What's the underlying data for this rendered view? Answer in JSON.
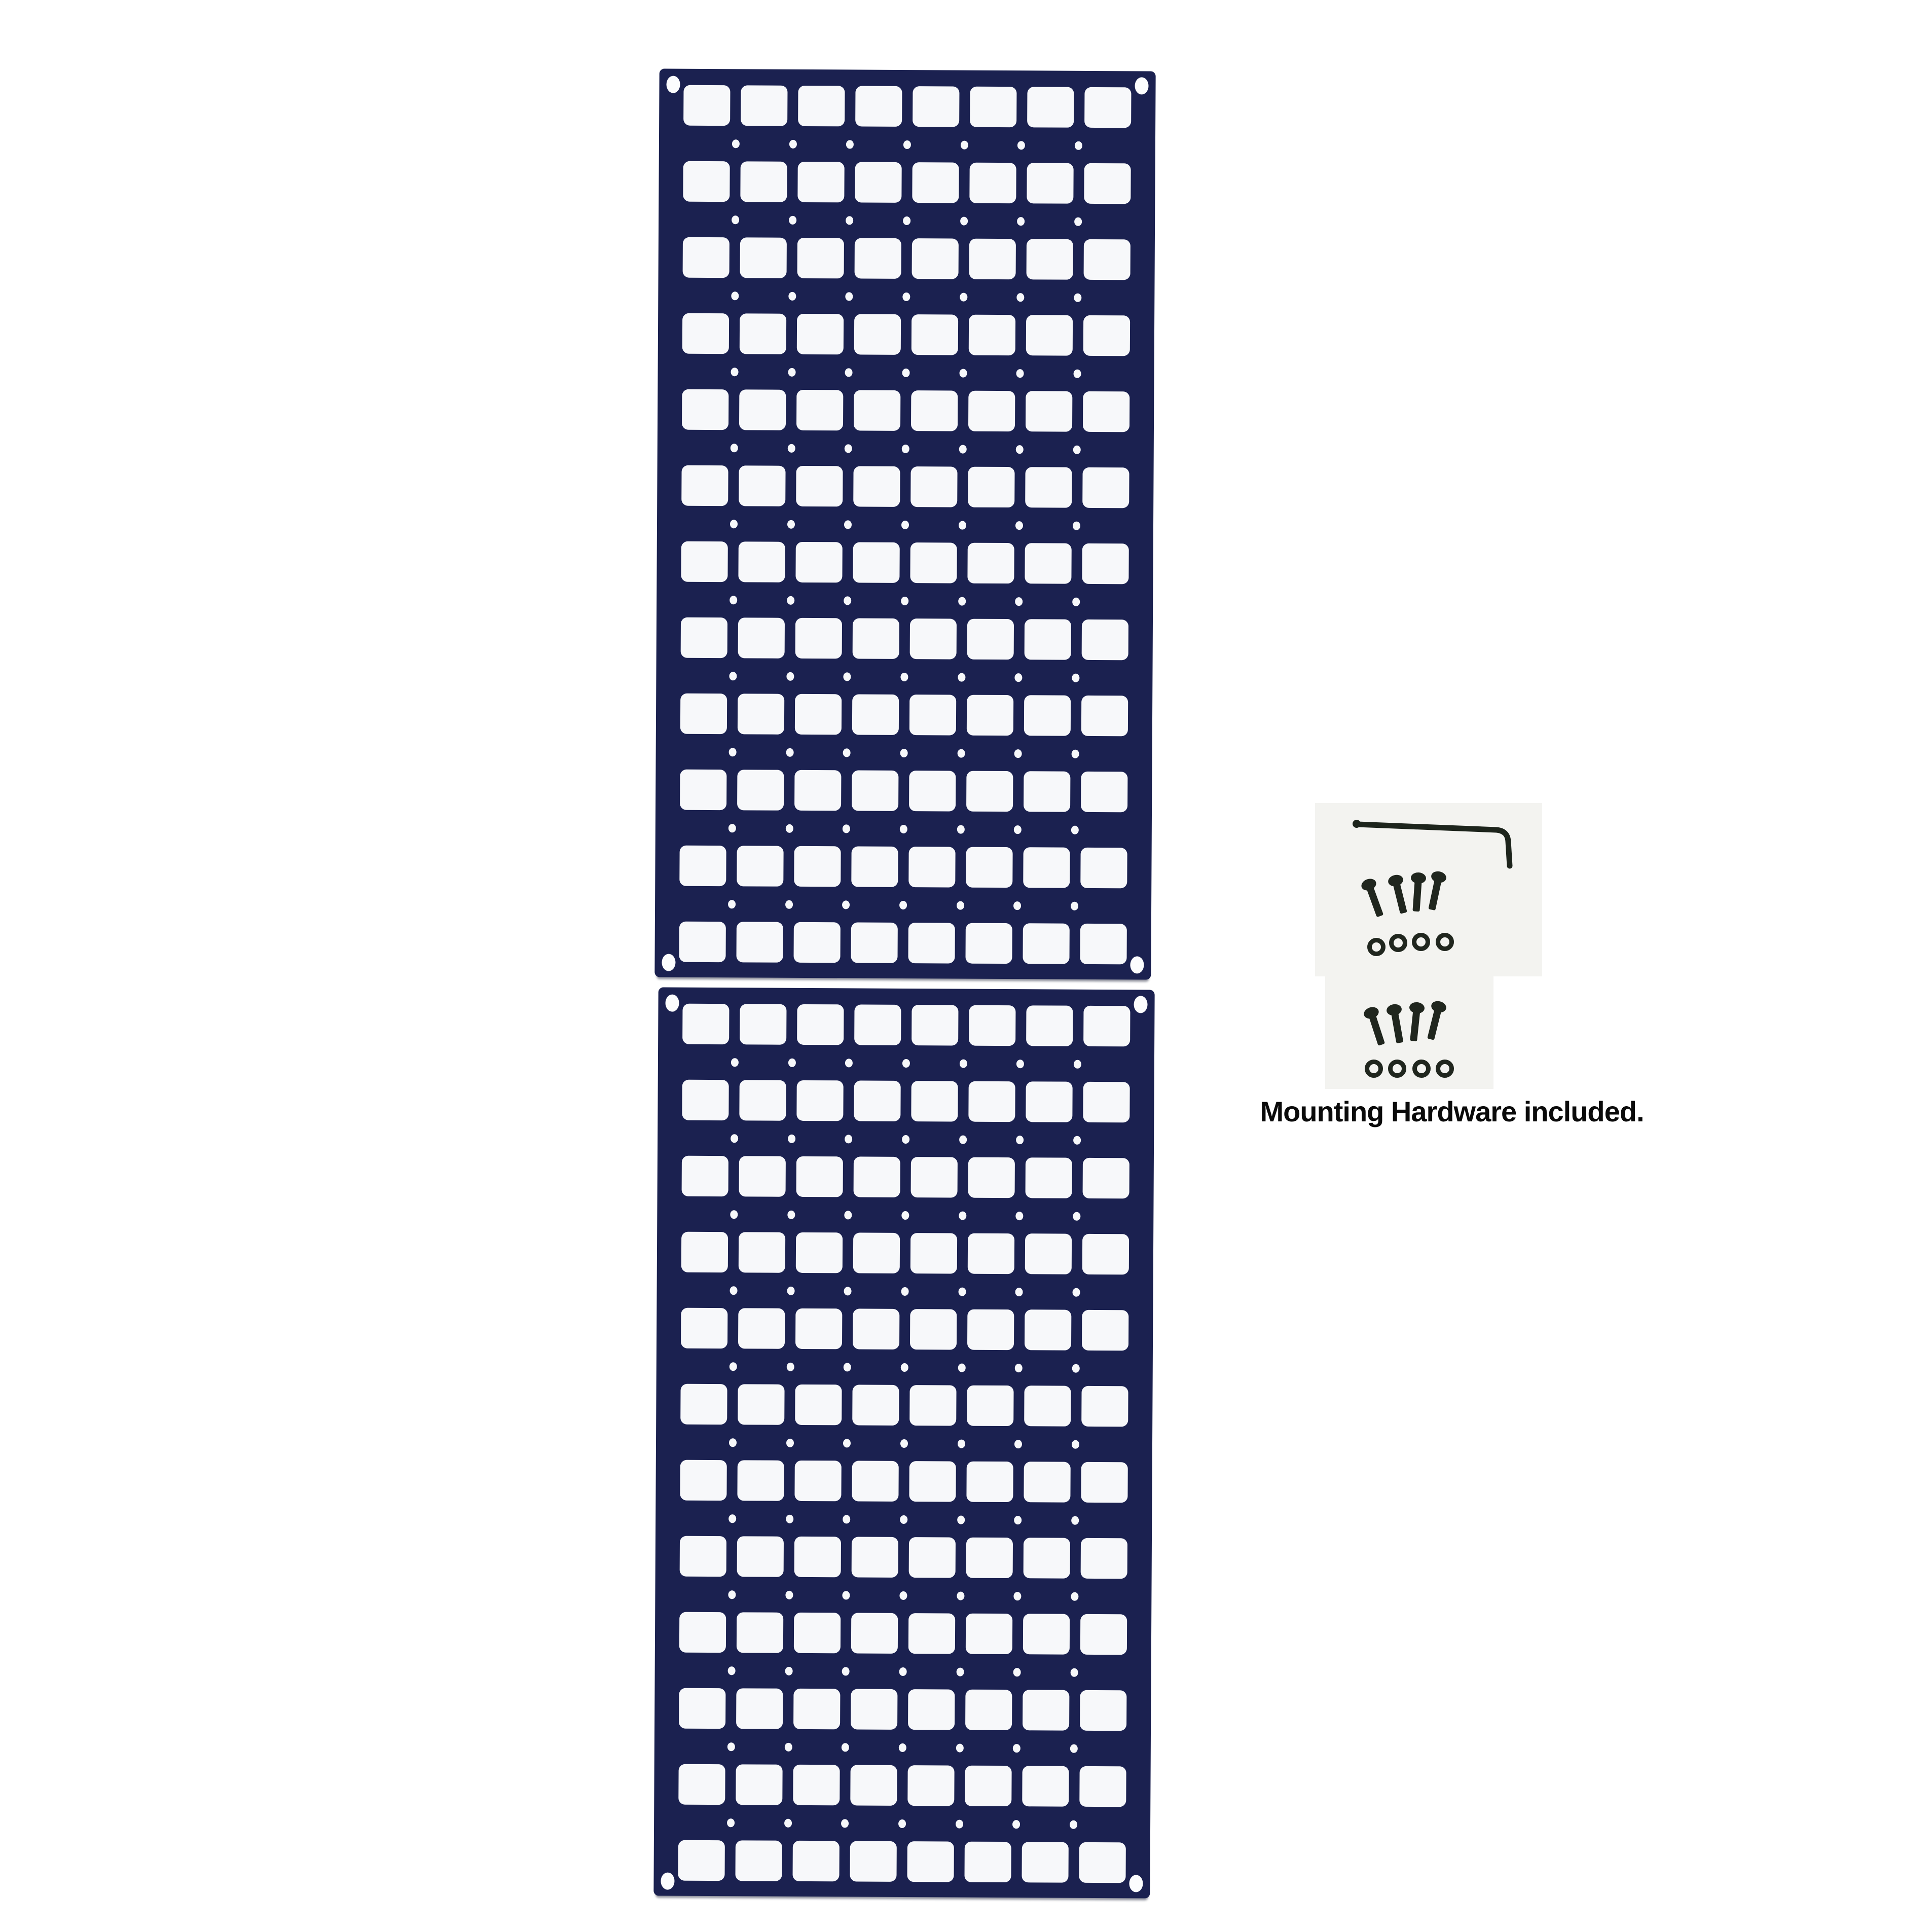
{
  "image_type": "product-photo",
  "caption": "Mounting Hardware included.",
  "colors": {
    "background": "#ffffff",
    "panel": "#1b2150",
    "cutout": "#f7f8fa",
    "tray": "#f3f3f0",
    "metal": "#20261e",
    "caption_text": "#0a0a0a"
  },
  "panels": {
    "count": 2,
    "rows": 12,
    "cols": 8,
    "dot_rows": 11,
    "dots_per_row": 7,
    "corner_holes_per_panel": 4
  },
  "hardware": {
    "allen_key_count": 1,
    "sets": [
      {
        "screws": 4,
        "washers": 4
      },
      {
        "screws": 4,
        "washers": 4
      }
    ]
  }
}
